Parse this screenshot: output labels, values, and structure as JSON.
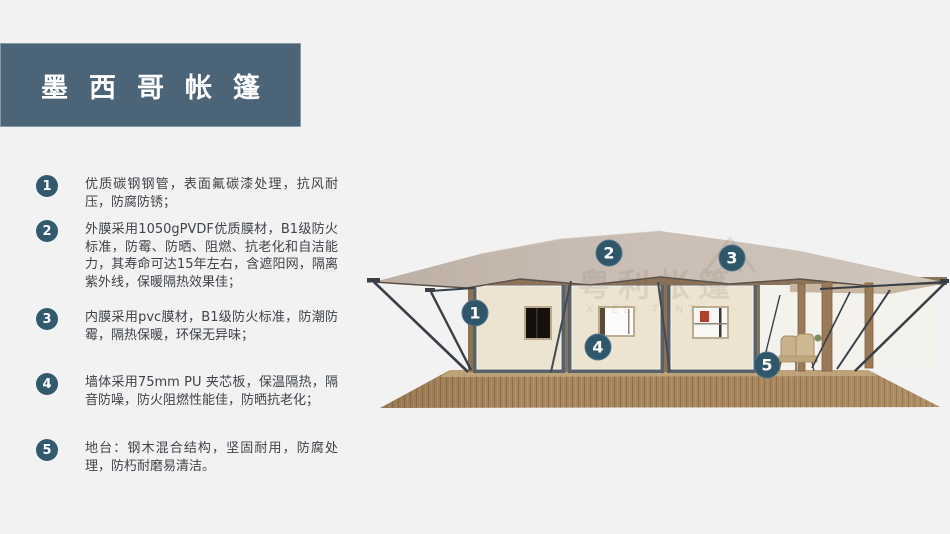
{
  "header": {
    "title": "墨西哥帐篷"
  },
  "features": [
    {
      "num": "1",
      "text": "优质碳钢钢管，表面氟碳漆处理，抗风耐压，防腐防锈；"
    },
    {
      "num": "2",
      "text": "外膜采用1050gPVDF优质膜材，B1级防火标准，防霉、防晒、阻燃、抗老化和自洁能力，其寿命可达15年左右，含遮阳网，隔离紫外线，保暖隔热效果佳；"
    },
    {
      "num": "3",
      "text": "内膜采用pvc膜材，B1级防火标准，防潮防霉，隔热保暖，环保无异味；"
    },
    {
      "num": "4",
      "text": "墙体采用75mm PU 夹芯板，保温隔热，隔音防噪，防火阻燃性能佳，防晒抗老化；"
    },
    {
      "num": "5",
      "text": "地台：钢木混合结构，坚固耐用，防腐处理，防朽耐磨易清洁。"
    }
  ],
  "diagram": {
    "watermark_cn": "粤利帐篷",
    "watermark_en": "XUELI TENT",
    "callouts": [
      {
        "num": "1",
        "x": 125,
        "y": 93
      },
      {
        "num": "2",
        "x": 259,
        "y": 33
      },
      {
        "num": "3",
        "x": 382,
        "y": 38
      },
      {
        "num": "4",
        "x": 248,
        "y": 127
      },
      {
        "num": "5",
        "x": 417,
        "y": 145
      }
    ]
  },
  "colors": {
    "background": "#f2f2f2",
    "banner": "#4b6478",
    "badge": "#33596d",
    "callout": "#30566a",
    "body_text": "#3f4449",
    "roof": "#c8bcb2",
    "wall": "#ece3d1",
    "frame": "#59616b",
    "deck_wood": "#a8875f",
    "beam_wood": "#8b7355"
  }
}
